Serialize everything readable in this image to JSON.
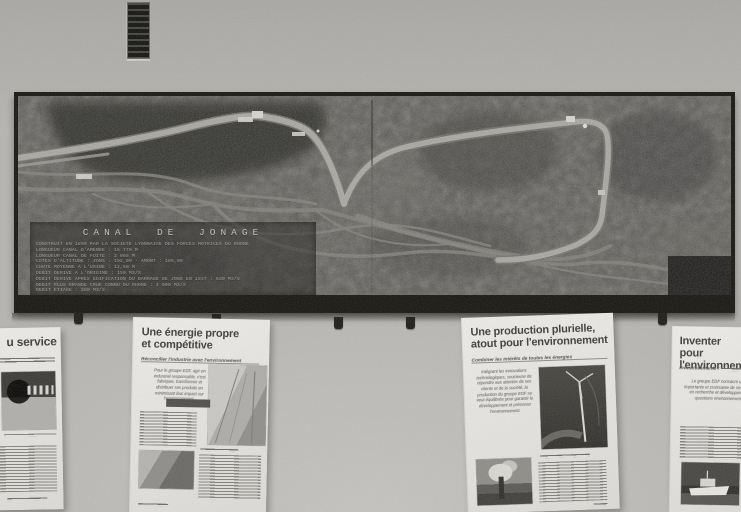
{
  "scene": {
    "description": "Photograph of a wall-mounted relief model of the Canal de Jonage with EDF information posters pinned below"
  },
  "colors": {
    "wall": "#b6b4b0",
    "model_frame": "#16150f",
    "terrain": "#52504b",
    "canal_water": "#a7a59f",
    "river_water": "#7d7b75",
    "paper": "#eae9e5",
    "ink": "#3d3c39",
    "plaque_text": "#aeaca6"
  },
  "model": {
    "plaque": {
      "title": "CANAL  DE  JONAGE",
      "lines": [
        "CONSTRUIT EN 1899 PAR LA SOCIETE LYONNAISE DES FORCES MOTRICES DU RHONE",
        "LONGUEUR CANAL D'AMENEE : 15 770 M",
        "LONGUEUR CANAL DE FUITE : 3 065 M",
        "COTES D'ALTITUDE : JONS : 192,00 - AMONT : 186,00",
        "CHUTE MOYENNE A L'USINE : 12,50 M",
        "DEBIT DERIVE A L'ORIGINE : 150 M3/S",
        "DEBIT DERIVE APRES EDIFICATION DU BARRAGE DE JONS EN 1937 : 639 M3/S",
        "DEBIT PLUS GRANDE CRUE CONNU DU RHONE : 4 900 M3/S",
        "DEBIT ETIAGE : 200 M3/S"
      ]
    }
  },
  "posters": {
    "service": {
      "title_fragment": "u service"
    },
    "energie": {
      "title_line1": "Une énergie propre",
      "title_line2": "et compétitive",
      "subtitle": "Réconcilier l'industrie avec l'environnement",
      "intro": "Pour le groupe EDF, agir en industriel responsable, c'est fabriquer, transformer et distribuer ses produits en minimisant leur impact sur l'environnement."
    },
    "production": {
      "title_line1": "Une production plurielle,",
      "title_line2": "atout pour l'environnement",
      "subtitle": "Combiner les intérêts de toutes les énergies",
      "intro": "Intégrant les innovations technologiques, soucieuse de répondre aux attentes de ses clients et de la société, la production du groupe EDF se veut équilibrée pour garantir le développement et préserver l'environnement."
    },
    "inventer": {
      "title_line1": "Inventer",
      "title_line2": "pour l'environnement",
      "subtitle_fragment": "Investissements :",
      "intro": "Le groupe EDF consacre une part importante et croissante de ses dépenses en recherche et développement aux questions environnementales."
    }
  }
}
